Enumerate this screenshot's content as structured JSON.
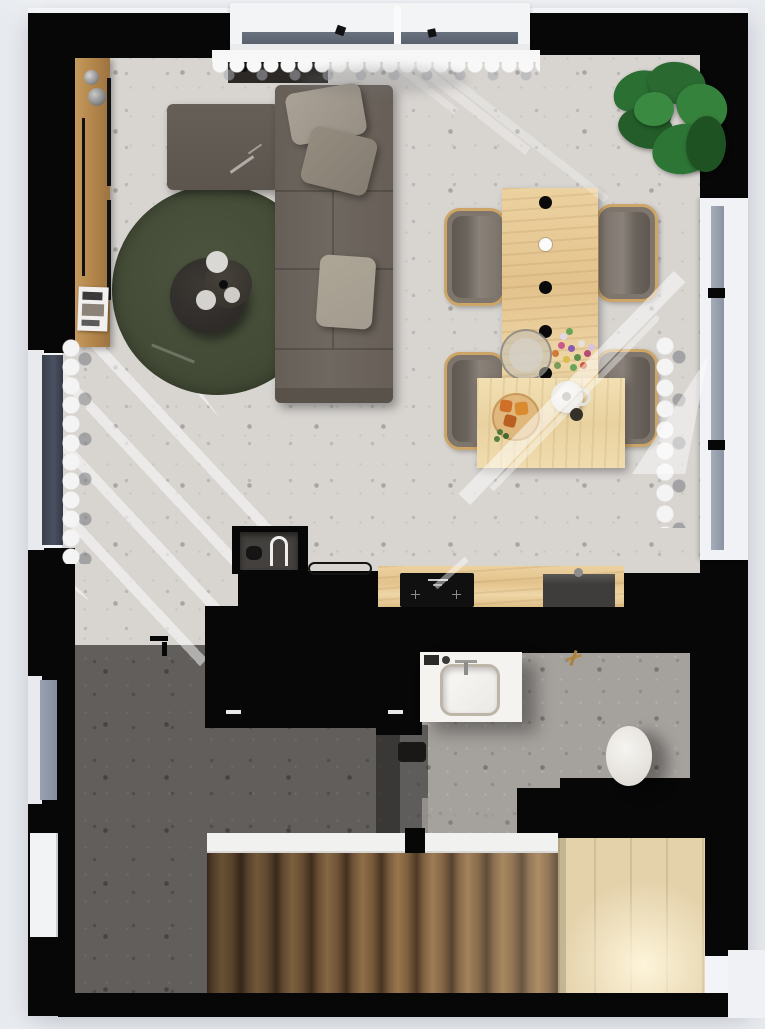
{
  "meta": {
    "label": "Top-down 3D floor-plan rendering of a small apartment",
    "width_px": 765,
    "height_px": 1029,
    "view": "top-down orthographic",
    "style": "photorealistic render, no text"
  },
  "palette": {
    "wall_black": "#070707",
    "floor_living": "#d8d5d1",
    "floor_hall": "#615e5b",
    "floor_bath": "#a5a19d",
    "rug_green": "#47503a",
    "sofa_gray": "#6b645c",
    "pillow_gray": "#a49c90",
    "wood_table": "#e9cb97",
    "wood_sideboard": "#b98e54",
    "stair_tread": "#7b5c3c",
    "stair_landing": "#e4d2ab",
    "plant_green": "#2d7535",
    "window_glass": "#98a0ad",
    "curtain_white": "#f6f6f6",
    "outside": "#eff1f5"
  },
  "rooms": [
    {
      "id": "living-room",
      "label": "Living room",
      "floor": "light terrazzo"
    },
    {
      "id": "dining-area",
      "label": "Dining area",
      "floor": "light terrazzo"
    },
    {
      "id": "kitchen",
      "label": "Kitchen",
      "floor": "light terrazzo"
    },
    {
      "id": "hallway",
      "label": "Hallway",
      "floor": "dark terrazzo"
    },
    {
      "id": "bathroom",
      "label": "Bathroom",
      "floor": "grey terrazzo"
    },
    {
      "id": "staircase",
      "label": "Staircase with landing"
    }
  ],
  "furniture": {
    "sideboard": {
      "label": "Wooden sideboard along left wall with two metal cups and a magazine"
    },
    "console": {
      "label": "Dark console behind sofa under the window"
    },
    "sofa": {
      "label": "Corner sofa with left chaise, warm grey fabric",
      "pillow_count": 3
    },
    "rug": {
      "label": "Round dark-olive rug"
    },
    "coffee_tables": {
      "label": "Two round dark nesting coffee tables with white plates",
      "count": 2
    },
    "dining_table": {
      "label": "Narrow light-wood dining table",
      "pendant_dots": [
        {
          "color": "black"
        },
        {
          "color": "white"
        },
        {
          "color": "black"
        },
        {
          "color": "black"
        },
        {
          "color": "black"
        }
      ],
      "decor": [
        "glass bowl",
        "colourful flower bouquet"
      ]
    },
    "dining_chairs": {
      "label": "Grey upholstered chair with bentwood frame",
      "count": 4
    },
    "serving_table": {
      "label": "Lower pale-wood serving table with cutting board, snacks and teapot"
    },
    "plant": {
      "label": "Large potted green plant in top-right corner"
    },
    "kitchen_island": {
      "label": "Black kitchen island with white handle strips"
    },
    "kitchen_counter": {
      "label": "Wooden worktop",
      "appliances": [
        "black induction cooktop",
        "dark undermount sink with faucet"
      ]
    },
    "niche": {
      "label": "Dark wall niche with arched white lamp"
    },
    "tray": {
      "label": "Thin black tray on counter edge"
    },
    "vanity": {
      "label": "White bathroom vanity with square basin and faucet"
    },
    "toilet": {
      "label": "White toilet"
    },
    "towel_hook": {
      "label": "Brass towel hook on bathroom wall"
    },
    "stairs": {
      "label": "Straight wooden staircase",
      "tread_count": 10,
      "landing": "bright light-wood platform",
      "edge": "white landing strip"
    }
  },
  "openings": {
    "top_balcony_window": {
      "label": "Wide balcony window with scalloped sheer curtain"
    },
    "left_window_upper": {
      "label": "Tall dark-glass window, living-room left wall"
    },
    "left_window_lower": {
      "label": "Window, hallway left wall"
    },
    "left_entry_door": {
      "label": "White entry door, lower-left wall"
    },
    "right_window": {
      "label": "Tall window with gathered sheer curtain, right wall"
    }
  },
  "lighting": {
    "label": "Warm sunlight",
    "beams": [
      "diagonal stripes from the left window",
      "wide diagonal beam across dining and serving tables",
      "soft streaks under the top window",
      "bright glow on the stair landing"
    ]
  }
}
